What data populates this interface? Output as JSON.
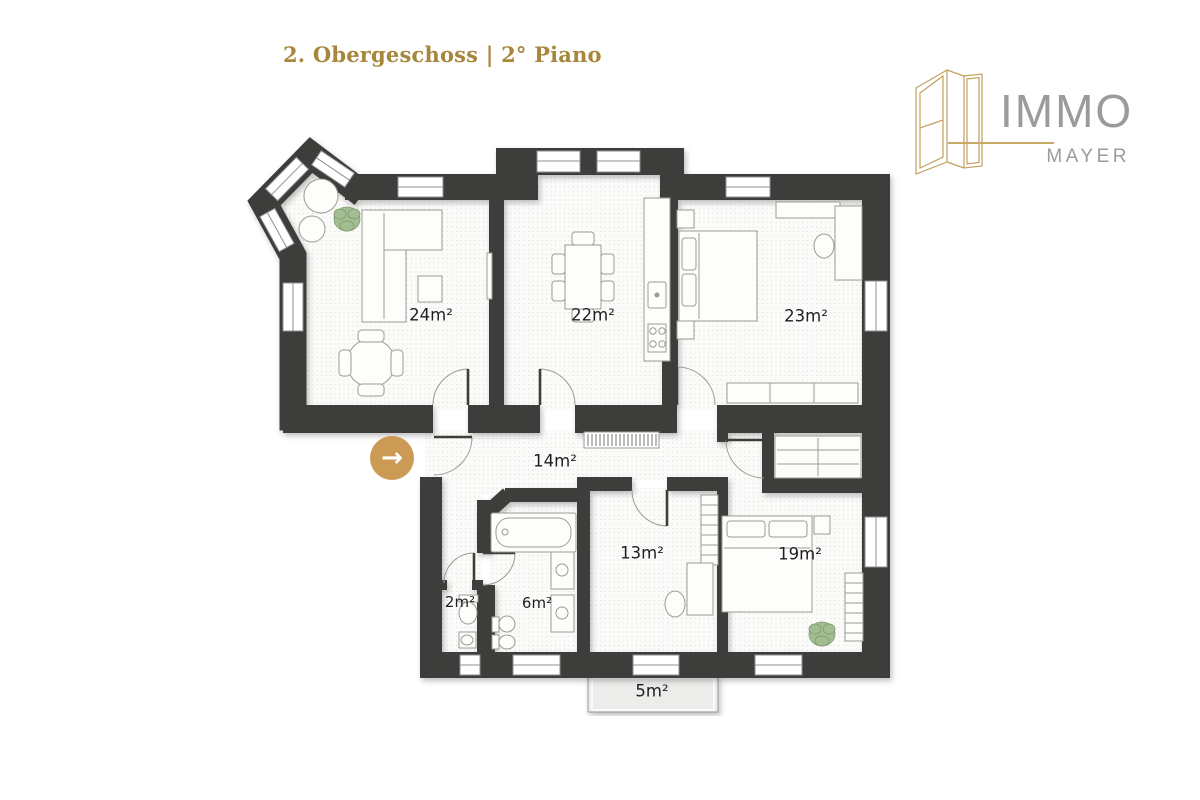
{
  "header": {
    "title": "2. Obergeschoss | 2° Piano"
  },
  "logo": {
    "brand": "IMMO",
    "subbrand": "MAYER"
  },
  "rooms": [
    {
      "id": "living-room",
      "area": "24m²"
    },
    {
      "id": "kitchen-dining",
      "area": "22m²"
    },
    {
      "id": "bedroom-large",
      "area": "23m²"
    },
    {
      "id": "hallway",
      "area": "14m²"
    },
    {
      "id": "room-small",
      "area": "13m²"
    },
    {
      "id": "bedroom-second",
      "area": "19m²"
    },
    {
      "id": "wc",
      "area": "2m²"
    },
    {
      "id": "bathroom",
      "area": "6m²"
    },
    {
      "id": "balcony",
      "area": "5m²"
    }
  ],
  "entrance": {
    "symbol": "→"
  },
  "colors": {
    "wall": "#3d3d3a",
    "title_gold": "#a6873b",
    "logo_gold": "#c2a05e",
    "logo_gray": "#9b9b99",
    "arrow_circle": "#cb9a55",
    "plant_green": "#a3bd93"
  }
}
